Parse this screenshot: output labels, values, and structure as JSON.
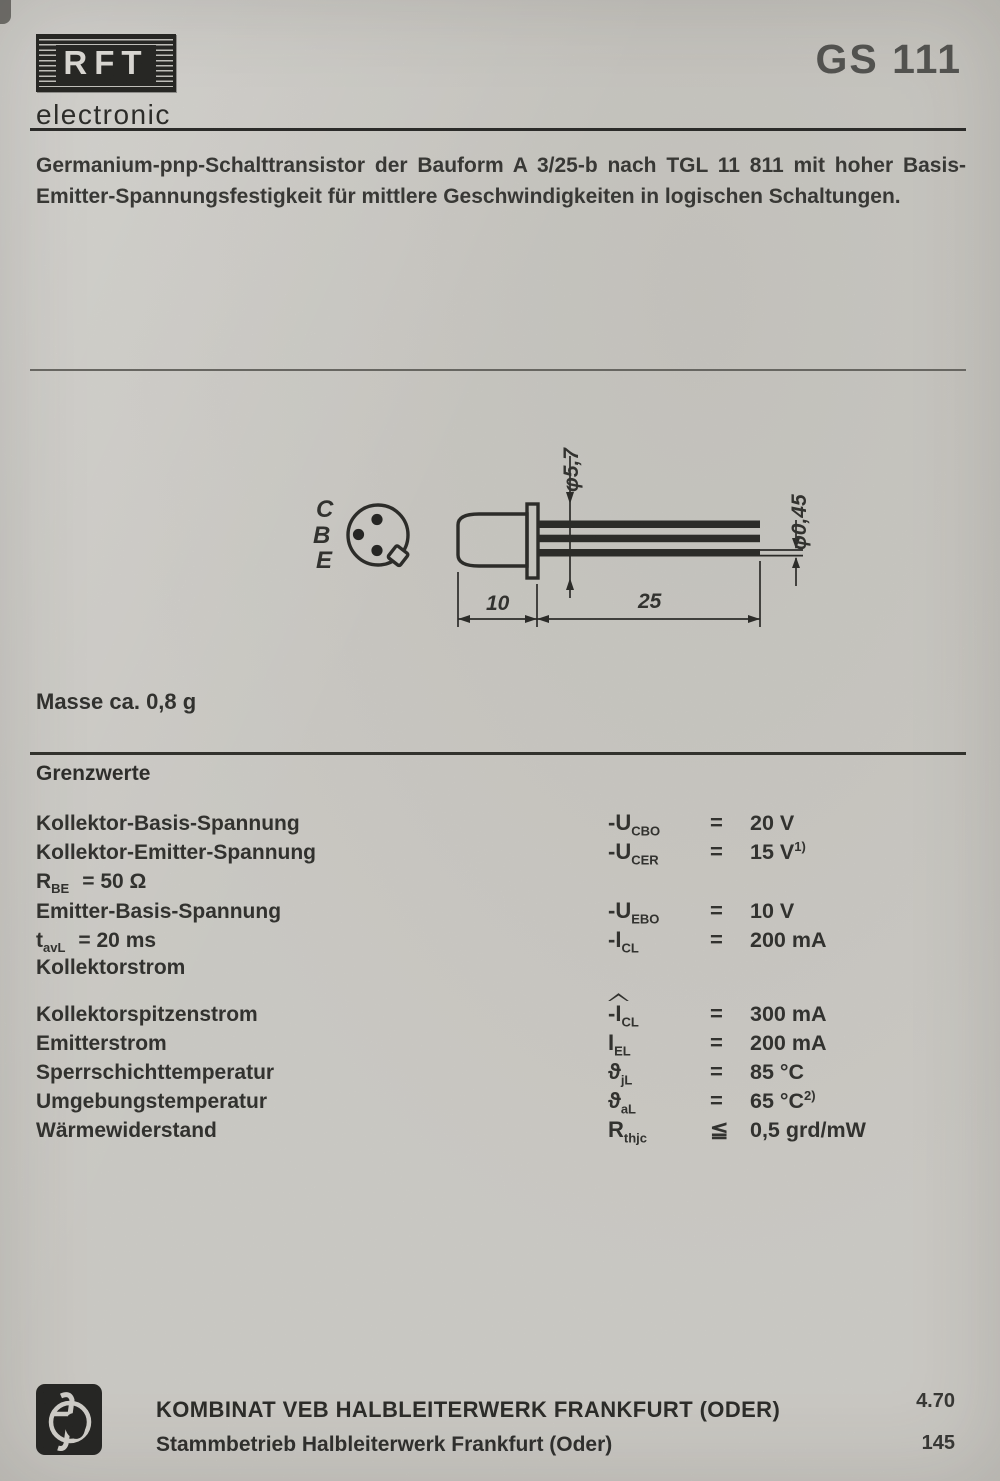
{
  "colors": {
    "paper": "#d8d6d1",
    "ink": "#242422",
    "part_ink": "#4a4a48"
  },
  "header": {
    "brand": "RFT",
    "brand_suffix": "electronic",
    "part_number": "GS 111"
  },
  "description": {
    "line1": "Germanium-pnp-Schalttransistor der Bauform A 3/25-b nach TGL 11 811 mit hoher Basis-",
    "line2": "Emitter-Spannungsfestigkeit für mittlere Geschwindigkeiten in logischen Schaltungen."
  },
  "drawing": {
    "pin_labels": [
      "C",
      "B",
      "E"
    ],
    "dim_flange_diameter": "φ5,7",
    "dim_lead_diameter": "φ0,45",
    "dim_body_length": "10",
    "dim_lead_length": "25"
  },
  "mass_note": "Masse ca. 0,8 g",
  "limits": {
    "title": "Grenzwerte",
    "rows": [
      {
        "label": {
          "pre": "Kollektor-Basis-Spannung"
        },
        "symbol": {
          "pre": "-U",
          "sub": "CBO"
        },
        "relation": "=",
        "value": "20 V"
      },
      {
        "label": {
          "pre": "Kollektor-Emitter-Spannung"
        },
        "symbol": {
          "pre": "-U",
          "sub": "CER"
        },
        "relation": "=",
        "value": "15 V",
        "value_sup": "1)"
      },
      {
        "label": {
          "pre": "R",
          "sub": "BE",
          "rest": "=  50 Ω"
        }
      },
      {
        "label": {
          "pre": "Emitter-Basis-Spannung"
        },
        "symbol": {
          "pre": "-U",
          "sub": "EBO"
        },
        "relation": "=",
        "value": "10 V"
      },
      {
        "label": {
          "pre": "t",
          "sub": "avL",
          "rest": "=  20 ms"
        },
        "symbol": {
          "pre": "-I",
          "sub": "CL"
        },
        "relation": "=",
        "value": "200 mA"
      },
      {
        "label": {
          "pre": "Kollektorstrom"
        }
      },
      {
        "label": {
          "pre": "Kollektorspitzenstrom"
        },
        "symbol": {
          "pre": "-I",
          "sub": "CL"
        },
        "relation": "=",
        "value": "300 mA"
      },
      {
        "label": {
          "pre": "Emitterstrom"
        },
        "symbol": {
          "pre": "I",
          "sub": "EL"
        },
        "relation": "=",
        "value": "200 mA"
      },
      {
        "label": {
          "pre": "Sperrschichttemperatur"
        },
        "symbol": {
          "pre": "ϑ",
          "sub": "jL"
        },
        "relation": "=",
        "value": "85 °C"
      },
      {
        "label": {
          "pre": "Umgebungstemperatur"
        },
        "symbol": {
          "pre": "ϑ",
          "sub": "aL"
        },
        "relation": "=",
        "value": "65 °C",
        "value_sup": "2)"
      },
      {
        "label": {
          "pre": "Wärmewiderstand"
        },
        "symbol": {
          "pre": "R",
          "sub": "thjc"
        },
        "relation": "≦",
        "value": "0,5 grd/mW"
      }
    ]
  },
  "footer": {
    "company_line1": "KOMBINAT VEB HALBLEITERWERK FRANKFURT (ODER)",
    "company_line2": "Stammbetrieb Halbleiterwerk Frankfurt (Oder)",
    "date_code": "4.70",
    "page_number": "145"
  }
}
